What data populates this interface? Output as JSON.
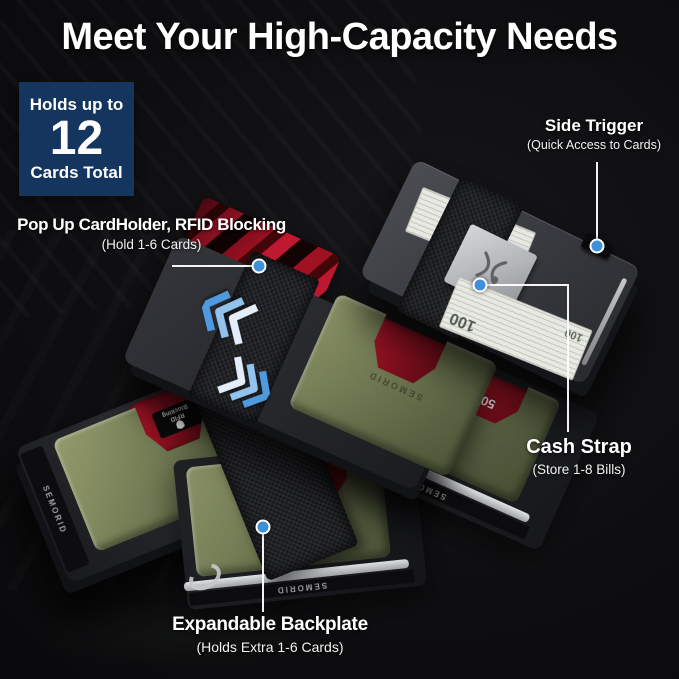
{
  "title": "Meet Your High-Capacity Needs",
  "badge": {
    "line1": "Holds up to",
    "number": "12",
    "line2": "Cards Total"
  },
  "callouts": {
    "popup": {
      "label": "Pop Up CardHolder, RFID Blocking",
      "sub": "(Hold 1-6 Cards)"
    },
    "side_trigger": {
      "label": "Side Trigger",
      "sub": "(Quick Access to Cards)"
    },
    "cash_strap": {
      "label": "Cash Strap",
      "sub": "(Store 1-8 Bills)"
    },
    "backplate": {
      "label": "Expandable Backplate",
      "sub": "(Holds Extra 1-6 Cards)"
    }
  },
  "product": {
    "brand": "SEMORID",
    "rfid_badge_line1": "RFID",
    "rfid_badge_line2": "Blocking",
    "bill_value": "100",
    "card_value": "50",
    "card_letters": [
      "A",
      "A",
      "A"
    ]
  },
  "icons": {
    "logo": "butterfly-logo-icon",
    "popup_arrows": "triple-chevron-up-left-icon",
    "expand_arrows": "triple-chevron-down-right-icon",
    "shield": "shield-icon"
  },
  "colors": {
    "background": "#0e0e10",
    "badge_navy": "#14355e",
    "accent_blue": "#3e90d8",
    "chevron_blue": "#4f9ade",
    "plate_green": "#747d55",
    "card_red": "#9e1122",
    "body_gray": "#3a3b40",
    "strap_black": "#17181b",
    "bill_paper": "#e9e9e4",
    "rail_silver": "#c6c8cb",
    "text_white": "#ffffff"
  }
}
